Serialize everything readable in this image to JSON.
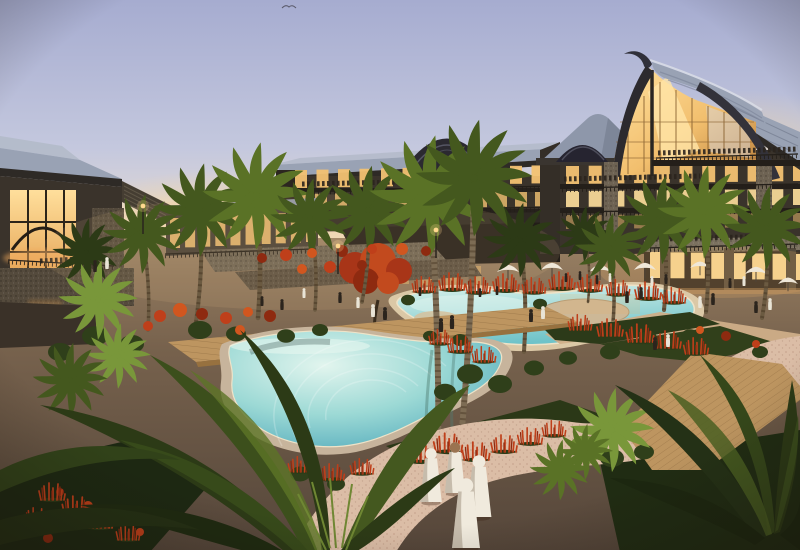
{
  "scene": {
    "title": "Dusk rendering of a tropical resort courtyard with lagoon pools, palm trees, timber-and-glass lodge buildings with a curved sail roof, wooden boardwalks, red flowering beds, and figures in white robes",
    "bird": {
      "x": 289,
      "y": 6
    },
    "palms": [
      {
        "bx": 92,
        "by": 332,
        "cx": 86,
        "cy": 252,
        "s": 0.72,
        "tone": "dark",
        "tw": 3,
        "layer": "back"
      },
      {
        "bx": 148,
        "by": 330,
        "cx": 142,
        "cy": 234,
        "s": 0.85,
        "tone": "mid",
        "tw": 3.5,
        "layer": "back"
      },
      {
        "bx": 196,
        "by": 322,
        "cx": 200,
        "cy": 210,
        "s": 1,
        "tone": "mid",
        "tw": 4,
        "layer": "back"
      },
      {
        "bx": 258,
        "by": 318,
        "cx": 256,
        "cy": 196,
        "s": 1.15,
        "tone": "light",
        "tw": 4.5,
        "layer": "back"
      },
      {
        "bx": 315,
        "by": 310,
        "cx": 310,
        "cy": 218,
        "s": 0.85,
        "tone": "mid",
        "tw": 3.5,
        "layer": "back"
      },
      {
        "bx": 362,
        "by": 302,
        "cx": 368,
        "cy": 210,
        "s": 0.95,
        "tone": "mid",
        "tw": 3.5,
        "layer": "back"
      },
      {
        "bx": 524,
        "by": 352,
        "cx": 520,
        "cy": 240,
        "s": 0.8,
        "tone": "dark",
        "tw": 4,
        "layer": "right"
      },
      {
        "bx": 588,
        "by": 302,
        "cx": 584,
        "cy": 234,
        "s": 0.6,
        "tone": "dark",
        "tw": 2.5,
        "layer": "right"
      },
      {
        "bx": 612,
        "by": 332,
        "cx": 610,
        "cy": 248,
        "s": 0.75,
        "tone": "mid",
        "tw": 3.5,
        "layer": "right"
      },
      {
        "bx": 664,
        "by": 310,
        "cx": 662,
        "cy": 220,
        "s": 0.95,
        "tone": "mid",
        "tw": 4,
        "layer": "right"
      },
      {
        "bx": 706,
        "by": 312,
        "cx": 704,
        "cy": 212,
        "s": 1,
        "tone": "light",
        "tw": 4,
        "layer": "right"
      },
      {
        "bx": 762,
        "by": 318,
        "cx": 766,
        "cy": 228,
        "s": 0.9,
        "tone": "mid",
        "tw": 4,
        "layer": "right"
      },
      {
        "bx": 438,
        "by": 468,
        "cx": 430,
        "cy": 196,
        "s": 1.3,
        "tone": "light",
        "tw": 6,
        "layer": "front"
      },
      {
        "bx": 460,
        "by": 450,
        "cx": 474,
        "cy": 178,
        "s": 1.25,
        "tone": "mid",
        "tw": 6,
        "layer": "front"
      }
    ],
    "ferns": [
      [
        612,
        430,
        0.9,
        "bright"
      ],
      [
        560,
        470,
        0.65,
        "light"
      ],
      [
        118,
        356,
        0.7,
        "bright"
      ],
      [
        70,
        380,
        0.8,
        "mid"
      ],
      [
        585,
        452,
        0.6,
        "light"
      ],
      [
        98,
        300,
        0.85,
        "bright"
      ]
    ],
    "people": [
      [
        95,
        272,
        12,
        0
      ],
      [
        107,
        269,
        12,
        1
      ],
      [
        373,
        317,
        13,
        1
      ],
      [
        385,
        320,
        13,
        0
      ],
      [
        441,
        332,
        14,
        0
      ],
      [
        452,
        329,
        14,
        0
      ],
      [
        531,
        322,
        13,
        0
      ],
      [
        543,
        319,
        13,
        1
      ],
      [
        627,
        303,
        12,
        0
      ],
      [
        641,
        299,
        12,
        0
      ],
      [
        700,
        308,
        12,
        1
      ],
      [
        713,
        305,
        12,
        0
      ],
      [
        756,
        313,
        12,
        0
      ],
      [
        770,
        310,
        12,
        1
      ],
      [
        340,
        303,
        11,
        0
      ],
      [
        304,
        298,
        10,
        1
      ],
      [
        566,
        282,
        9,
        0
      ],
      [
        580,
        280,
        9,
        0
      ],
      [
        652,
        286,
        10,
        1
      ],
      [
        666,
        284,
        10,
        0
      ],
      [
        730,
        288,
        10,
        0
      ],
      [
        744,
        286,
        10,
        1
      ],
      [
        480,
        297,
        9,
        0
      ],
      [
        497,
        295,
        9,
        0
      ],
      [
        597,
        284,
        9,
        0
      ],
      [
        610,
        282,
        9,
        1
      ],
      [
        655,
        350,
        13,
        0
      ],
      [
        668,
        347,
        13,
        1
      ],
      [
        282,
        310,
        11,
        0
      ],
      [
        262,
        306,
        10,
        0
      ],
      [
        358,
        308,
        11,
        1
      ],
      [
        420,
        296,
        9,
        0
      ]
    ],
    "figures": [
      [
        431,
        502,
        54,
        0
      ],
      [
        455,
        493,
        51,
        1
      ],
      [
        479,
        517,
        62,
        0
      ],
      [
        466,
        548,
        70,
        0
      ]
    ],
    "umbrellas": [
      [
        508,
        272,
        1
      ],
      [
        552,
        270,
        1
      ],
      [
        600,
        272,
        1
      ],
      [
        645,
        270,
        1
      ],
      [
        700,
        268,
        0.9
      ],
      [
        756,
        274,
        1
      ],
      [
        788,
        284,
        0.9
      ]
    ],
    "spikes": [
      [
        424,
        292,
        0.9
      ],
      [
        452,
        290,
        1
      ],
      [
        478,
        293,
        0.95
      ],
      [
        506,
        291,
        1
      ],
      [
        534,
        293,
        0.9
      ],
      [
        562,
        289,
        1
      ],
      [
        590,
        291,
        0.95
      ],
      [
        618,
        295,
        0.9
      ],
      [
        648,
        299,
        1
      ],
      [
        674,
        303,
        0.9
      ],
      [
        610,
        336,
        1
      ],
      [
        640,
        342,
        1.05
      ],
      [
        668,
        348,
        1
      ],
      [
        696,
        354,
        0.95
      ],
      [
        580,
        330,
        0.9
      ],
      [
        460,
        352,
        0.95
      ],
      [
        484,
        362,
        0.9
      ],
      [
        440,
        344,
        0.85
      ],
      [
        448,
        452,
        1.1
      ],
      [
        476,
        460,
        1.05
      ],
      [
        504,
        452,
        1
      ],
      [
        530,
        444,
        0.95
      ],
      [
        554,
        436,
        0.9
      ],
      [
        420,
        462,
        1
      ],
      [
        300,
        472,
        0.9
      ],
      [
        332,
        480,
        0.95
      ],
      [
        362,
        474,
        0.9
      ],
      [
        52,
        500,
        1
      ],
      [
        76,
        514,
        1.05
      ],
      [
        100,
        528,
        1
      ],
      [
        36,
        524,
        0.95
      ],
      [
        128,
        540,
        0.9
      ]
    ],
    "bushes": [
      [
        470,
        374,
        13,
        0
      ],
      [
        500,
        384,
        12,
        0
      ],
      [
        445,
        392,
        11,
        0
      ],
      [
        534,
        368,
        10,
        0
      ],
      [
        568,
        358,
        9,
        0
      ],
      [
        610,
        352,
        10,
        0
      ],
      [
        648,
        338,
        9,
        0
      ],
      [
        200,
        330,
        12,
        0
      ],
      [
        236,
        334,
        10,
        0
      ],
      [
        95,
        336,
        13,
        0
      ],
      [
        132,
        344,
        12,
        0
      ],
      [
        60,
        352,
        12,
        0
      ],
      [
        690,
        336,
        9,
        0
      ],
      [
        584,
        446,
        14,
        1
      ],
      [
        612,
        458,
        12,
        0
      ],
      [
        644,
        452,
        10,
        0
      ],
      [
        286,
        336,
        9,
        0
      ],
      [
        320,
        330,
        8,
        0
      ],
      [
        760,
        352,
        8,
        0
      ],
      [
        460,
        340,
        8,
        0
      ],
      [
        430,
        336,
        7,
        0
      ],
      [
        408,
        300,
        7,
        0
      ],
      [
        540,
        304,
        7,
        0
      ],
      [
        300,
        474,
        10,
        0
      ],
      [
        336,
        484,
        9,
        0
      ]
    ],
    "blooms": [
      [
        262,
        258,
        5
      ],
      [
        286,
        255,
        6
      ],
      [
        312,
        253,
        5
      ],
      [
        342,
        251,
        6
      ],
      [
        372,
        249,
        5
      ],
      [
        402,
        249,
        6
      ],
      [
        426,
        251,
        5
      ],
      [
        330,
        267,
        6
      ],
      [
        302,
        269,
        5
      ],
      [
        362,
        265,
        5
      ],
      [
        160,
        316,
        6
      ],
      [
        180,
        310,
        7
      ],
      [
        202,
        314,
        6
      ],
      [
        226,
        318,
        6
      ],
      [
        248,
        312,
        5
      ],
      [
        270,
        316,
        6
      ],
      [
        148,
        326,
        5
      ],
      [
        240,
        330,
        5
      ],
      [
        60,
        492,
        4
      ],
      [
        88,
        506,
        5
      ],
      [
        116,
        520,
        4
      ],
      [
        48,
        538,
        5
      ],
      [
        140,
        532,
        4
      ],
      [
        700,
        330,
        4
      ],
      [
        726,
        336,
        5
      ],
      [
        756,
        344,
        4
      ]
    ],
    "window_rows": [
      {
        "x0": 295,
        "y0": 170,
        "x1": 553,
        "y1": 165,
        "step": 20,
        "w": 12,
        "h": 18,
        "f": "window_warm",
        "o": 0.95,
        "g": "winC"
      },
      {
        "x0": 295,
        "y0": 194,
        "x1": 555,
        "y1": 190,
        "step": 20,
        "w": 12,
        "h": 16,
        "f": "window_warm",
        "o": 0.8,
        "g": "winC"
      },
      {
        "x0": 566,
        "y0": 166,
        "x1": 793,
        "y1": 163,
        "step": 21,
        "w": 13,
        "h": 18,
        "f": "window_warm",
        "o": 0.95,
        "g": "winR"
      },
      {
        "x0": 566,
        "y0": 191,
        "x1": 793,
        "y1": 189,
        "step": 21,
        "w": 13,
        "h": 16,
        "f": "window_bright",
        "o": 0.9,
        "g": "winR"
      },
      {
        "x0": 566,
        "y0": 215,
        "x1": 793,
        "y1": 213,
        "step": 21,
        "w": 13,
        "h": 14,
        "f": "window_warm",
        "o": 0.5,
        "g": "winR"
      },
      {
        "x0": 650,
        "y0": 252,
        "x1": 793,
        "y1": 254,
        "step": 19,
        "w": 14,
        "h": 26,
        "f": "window_bright",
        "o": 0.95,
        "g": "winS"
      },
      {
        "x0": 170,
        "y0": 218,
        "x1": 306,
        "y1": 212,
        "step": 15,
        "w": 10,
        "h": 30,
        "f": "window_warm",
        "o": 0.85,
        "g": "winCons"
      },
      {
        "x0": 398,
        "y0": 262,
        "x1": 470,
        "y1": 266,
        "step": 24,
        "w": 11,
        "h": 22,
        "f": "window_warm",
        "o": 0.45,
        "g": "winDoor"
      }
    ],
    "railings": [
      [
        286,
        191,
        558,
        186,
        "gC_center"
      ],
      [
        286,
        212,
        560,
        207,
        "gC_center"
      ],
      [
        165,
        254,
        312,
        249,
        "gC_center"
      ],
      [
        562,
        188,
        798,
        184,
        "gC_right"
      ],
      [
        562,
        212,
        798,
        209,
        "gC_right"
      ],
      [
        656,
        158,
        798,
        154,
        "gC_right"
      ],
      [
        650,
        248,
        798,
        244,
        "gC_terr"
      ],
      [
        8,
        260,
        114,
        266,
        "gC_left"
      ]
    ],
    "crowds": [
      [
        658,
        153,
        798,
        149,
        "gC_right"
      ],
      [
        564,
        179,
        700,
        176,
        "gC_right"
      ],
      [
        302,
        184,
        452,
        181,
        "gC_center"
      ],
      [
        655,
        239,
        788,
        236,
        "gC_terr"
      ],
      [
        40,
        261,
        80,
        259,
        "gC_left"
      ]
    ],
    "lamps": [
      [
        143,
        206
      ],
      [
        338,
        246
      ],
      [
        436,
        230
      ]
    ]
  },
  "palette": {
    "sky_top": "#a6acd0",
    "sky_mid": "#c4c8de",
    "sky_pink": "#e9dcd2",
    "sky_horizon": "#f6e3c4",
    "glow": "#fbdda6",
    "hill": "#6d6174",
    "roof_slate": "#99a2b4",
    "roof_light": "#b3bac9",
    "roof_dark": "#3b3733",
    "fascia": "#2e2a26",
    "timber": "#37302a",
    "facade": "#3a332b",
    "facade_dark": "#2c2620",
    "window_warm": "#f3c272",
    "window_bright": "#ffdf9c",
    "stone": "#6e6353",
    "stone_light": "#7b715f",
    "stone_dark": "#544a3c",
    "pool_light": "#d6f0e9",
    "pool_mid": "#8fd4d4",
    "pool_deep": "#58b4c2",
    "sand": "#dbc8a6",
    "coping": "#ece0c4",
    "deck": "#bd9560",
    "deck_dark": "#97713f",
    "path_pink": "#dbbda6",
    "path_tan": "#cfae88",
    "plaza": "#96764f",
    "ground_top": "#9a8164",
    "ground_mid": "#77624d",
    "ground_dark": "#55463a",
    "leaf_dark": "#243016",
    "leaf": "#35471d",
    "leaf_light": "#4c6322",
    "leaf_bright": "#6f8a33",
    "palm_dark": "#2c3a16",
    "palm_mid": "#44581e",
    "palm_light": "#5a7226",
    "palm_bright": "#79973a",
    "trunk": "#6b5a41",
    "trunk_light": "#7d6c54",
    "red": "#bf3f1a",
    "red_dark": "#8e2a10",
    "red_bright": "#d1561f",
    "robe": "#f0eadd",
    "people": "#2b241d",
    "white_shirt": "#e9e4d6",
    "umbrella": "#efe7d8",
    "lamp": "#ffd98e"
  }
}
